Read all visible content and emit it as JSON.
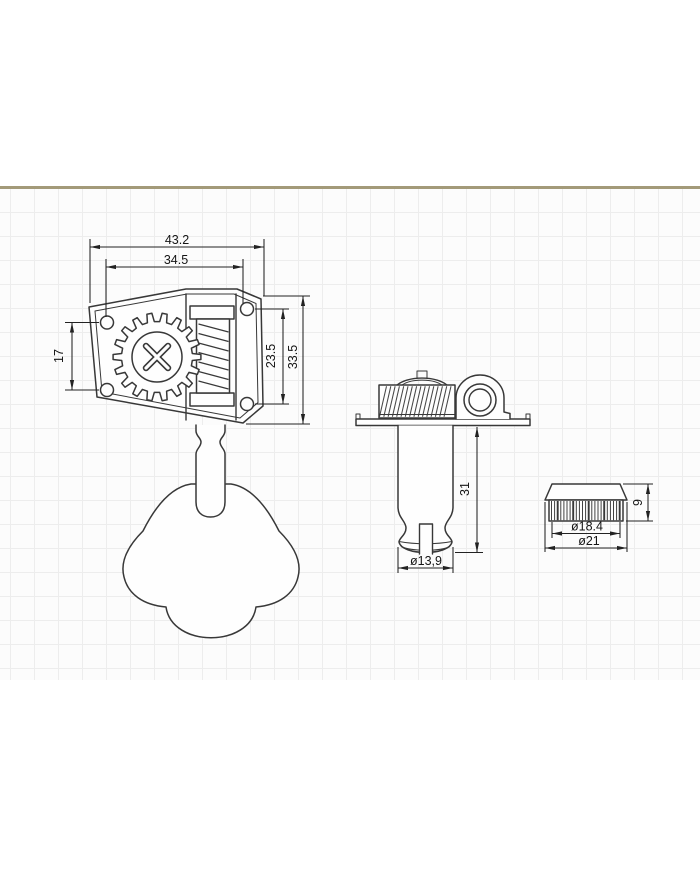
{
  "dimensions": {
    "front_view": {
      "overall_width": "43.2",
      "hole_span_horizontal": "34.5",
      "left_hole_span": "17",
      "right_hole_span": "23.5",
      "overall_height": "33.5"
    },
    "side_view": {
      "post_length": "31",
      "post_diameter": "ø13,9"
    },
    "bushing_view": {
      "barrel_height": "9",
      "inner_diameter": "ø18.4",
      "outer_diameter": "ø21"
    }
  },
  "colors": {
    "page_bg": "#ffffff",
    "paper_bg": "#fcfcfc",
    "grid_line": "#ededed",
    "paper_edge": "#a39a79",
    "ink": "#383838",
    "dim_ink": "#222222",
    "fill_white": "#fefefe"
  }
}
